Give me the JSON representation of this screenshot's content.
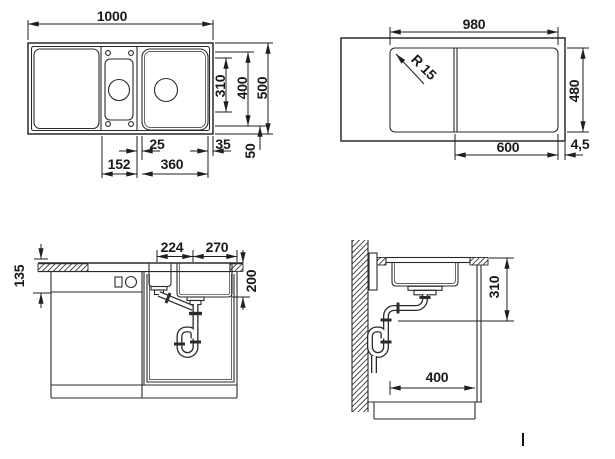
{
  "colors": {
    "line": "#2a2a2a",
    "text": "#1a1a1a",
    "background": "#ffffff"
  },
  "views": {
    "top": {
      "labels": {
        "overall_width": "1000",
        "inner_bowl_length": "310",
        "bowl_length": "400",
        "overall_depth": "500",
        "bowl_gap": "25",
        "right_edge": "35",
        "bottom_edge": "50",
        "ledge_width": "152",
        "bowl_width": "360"
      }
    },
    "underside": {
      "labels": {
        "base_width": "980",
        "corner_radius": "R 15",
        "base_depth": "480",
        "bowl_section_width": "600",
        "rim_offset": "4,5"
      }
    },
    "front": {
      "labels": {
        "front_height": "135",
        "drain_spacing_left": "224",
        "drain_spacing_right": "270",
        "bowl_depth": "200"
      }
    },
    "side": {
      "labels": {
        "outlet_height": "310",
        "outlet_distance": "400"
      }
    }
  }
}
